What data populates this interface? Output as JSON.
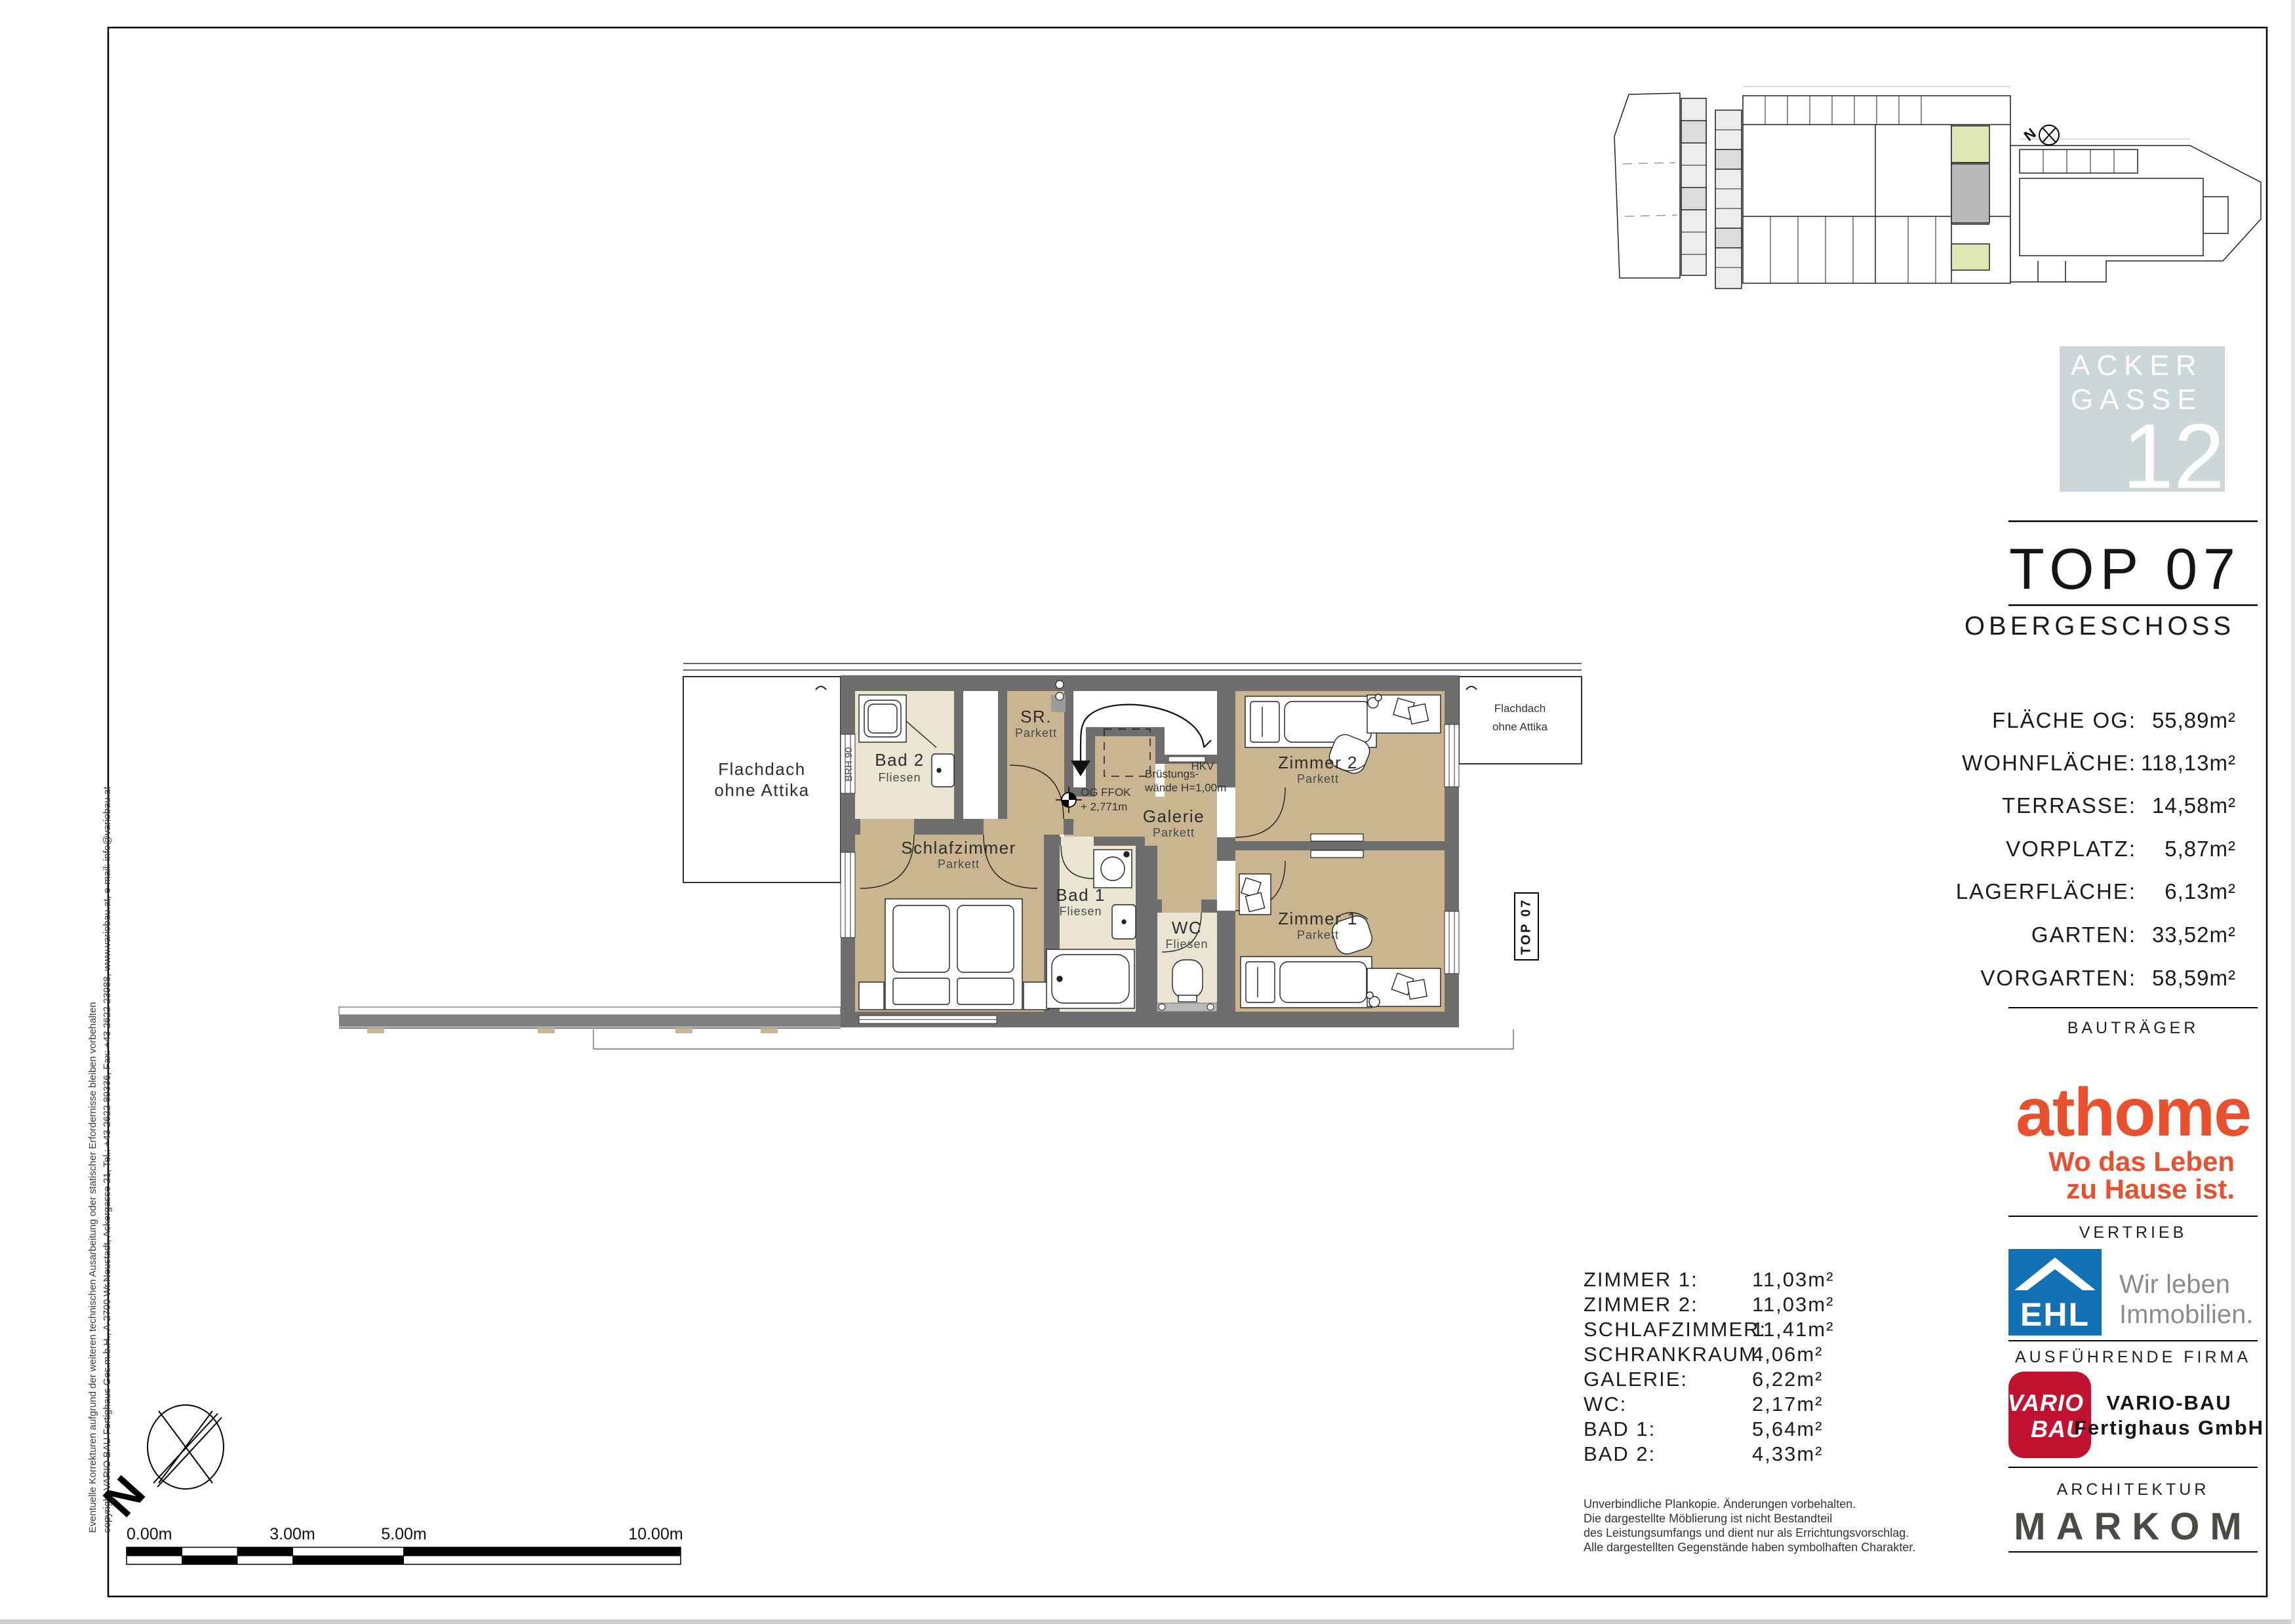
{
  "colors": {
    "parkett": "#c9b690",
    "fliesen": "#eae4d3",
    "wall": "#6e6e6e",
    "wall_light": "#9b9b9b",
    "terrace_gray": "#7f7f7f",
    "logo_square": "#cdd7d8",
    "athome_orange": "#e8502e",
    "ehl_blue": "#1272b5",
    "vario_red": "#c21231",
    "markom_gray": "#4b4b46",
    "site_green": "#dfe7b4",
    "site_gray": "#b9b9b9"
  },
  "titleblock": {
    "brand_square": {
      "line1": "ACKER",
      "line2": "GASSE",
      "number": "12"
    },
    "unit": "TOP 07",
    "floor": "OBERGESCHOSS",
    "areas": [
      {
        "label": "FLÄCHE OG:",
        "value": "55,89m²"
      },
      {
        "label": "WOHNFLÄCHE:",
        "value": "118,13m²"
      },
      {
        "label": "TERRASSE:",
        "value": "14,58m²"
      },
      {
        "label": "VORPLATZ:",
        "value": "5,87m²"
      },
      {
        "label": "LAGERFLÄCHE:",
        "value": "6,13m²"
      },
      {
        "label": "GARTEN:",
        "value": "33,52m²"
      },
      {
        "label": "VORGARTEN:",
        "value": "58,59m²"
      }
    ],
    "sections": {
      "developer": "BAUTRÄGER",
      "sales": "VERTRIEB",
      "contractor": "AUSFÜHRENDE FIRMA",
      "architecture": "ARCHITEKTUR"
    },
    "athome": {
      "wordmark": "athome",
      "tagline1": "Wo das Leben",
      "tagline2": "zu Hause ist."
    },
    "ehl": {
      "wordmark": "EHL",
      "slogan1": "Wir leben",
      "slogan2": "Immobilien."
    },
    "vario": {
      "logo_line1": "VARIO",
      "logo_line2": "BAU",
      "company_line1": "VARIO-BAU",
      "company_line2": "Fertighaus GmbH"
    },
    "markom_wordmark": "MARKOM"
  },
  "plan": {
    "rooms": {
      "bad2": {
        "name": "Bad 2",
        "finish": "Fliesen"
      },
      "sr": {
        "name": "SR.",
        "finish": "Parkett"
      },
      "schlafzimmer": {
        "name": "Schlafzimmer",
        "finish": "Parkett"
      },
      "galerie": {
        "name": "Galerie",
        "finish": "Parkett"
      },
      "bad1": {
        "name": "Bad 1",
        "finish": "Fliesen"
      },
      "wc": {
        "name": "WC",
        "finish": "Fliesen"
      },
      "zimmer2": {
        "name": "Zimmer 2",
        "finish": "Parkett"
      },
      "zimmer1": {
        "name": "Zimmer 1",
        "finish": "Parkett"
      }
    },
    "annotations": {
      "flachdach_line1": "Flachdach",
      "flachdach_line2": "ohne Attika",
      "brh": "BRH 90",
      "hkv": "HKV",
      "bruestung_line1": "Brüstungs-",
      "bruestung_line2": "wände H=1,00m",
      "level_line1": "OG FFOK",
      "level_line2": "+ 2,771m",
      "unit_tag": "TOP 07"
    }
  },
  "room_list": [
    {
      "label": "ZIMMER 1:",
      "value": "11,03m²"
    },
    {
      "label": "ZIMMER 2:",
      "value": "11,03m²"
    },
    {
      "label": "SCHLAFZIMMER:",
      "value": "11,41m²"
    },
    {
      "label": "SCHRANKRAUM:",
      "value": "4,06m²"
    },
    {
      "label": "GALERIE:",
      "value": "6,22m²"
    },
    {
      "label": "WC:",
      "value": "2,17m²"
    },
    {
      "label": "BAD 1:",
      "value": "5,64m²"
    },
    {
      "label": "BAD 2:",
      "value": "4,33m²"
    }
  ],
  "disclaimer": [
    "Unverbindliche Plankopie. Änderungen vorbehalten.",
    "Die dargestellte Möblierung ist nicht Bestandteil",
    "des Leistungsumfangs und dient nur als Errichtungsvorschlag.",
    "Alle dargestellten Gegenstände haben symbolhaften Charakter."
  ],
  "scalebar": {
    "l0": "0.00m",
    "l3": "3.00m",
    "l5": "5.00m",
    "l10": "10.00m"
  },
  "north_letter": "N",
  "margin_notes": {
    "line1": "Eventuelle Korrekturen aufgrund der weiteren technischen Ausarbeitung oder statischer Erfordernisse bleiben vorbehalten",
    "line2": "copyright VARIO BAU Fertighaus Ges.m.b.H., A-2700 Wr.Neustadt, Ackergasse 21, Tel.: +43 2622 89336, Fax: +43 2622 23988, www.variobau.at, e-mail: info@variobau.at"
  }
}
